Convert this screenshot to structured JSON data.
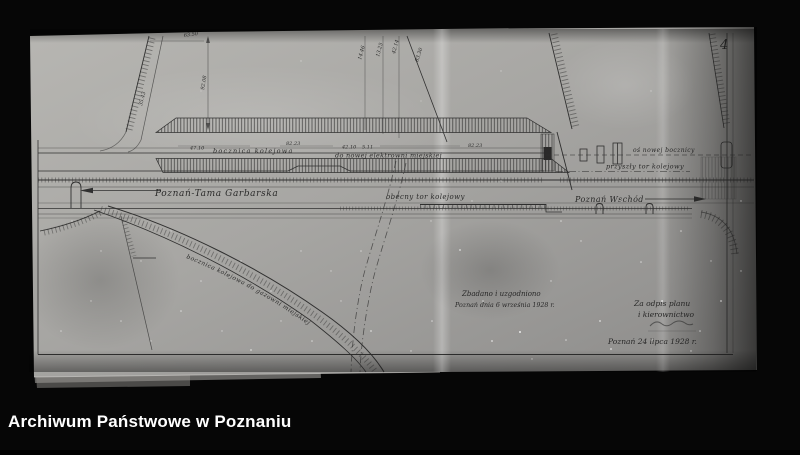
{
  "caption_bar": {
    "text": "Archiwum Państwowe w Poznaniu"
  },
  "scan": {
    "page_number": "4",
    "labels": {
      "main_line": "Poznań-Tama Garbarska",
      "current_track": "obecny tor kolejowy",
      "destination_right": "Poznań Wschód",
      "siding": "bocznica kolejowa",
      "to_power_plant": "do nowej elektrowni miejskiej",
      "new_siding_axis": "oś nowej bocznicy",
      "future_track": "przyszły tor kolejowy",
      "gasworks_siding": "bocznica kolejowa do gazowni miejskiej"
    },
    "annotations": {
      "reviewed_line1": "Zbadano i uzgodniono",
      "reviewed_line2": "Poznań dnia 6 września 1928 r.",
      "signature_line1": "Za odpis planu",
      "signature_line2": "i kierownictwo",
      "signature_date": "Poznań 24 lipca 1928 r."
    },
    "measurements": {
      "dim_top": "63.50",
      "dim_vert": "92.08",
      "dim_slope": "35.43",
      "km1": "14.46",
      "km2": "13.25",
      "km3": "42.14",
      "km4": "83.30",
      "len1": "47.10",
      "len2": "82.23",
      "len3": "42.10",
      "len4": "5.11",
      "len5": "82.23"
    }
  }
}
